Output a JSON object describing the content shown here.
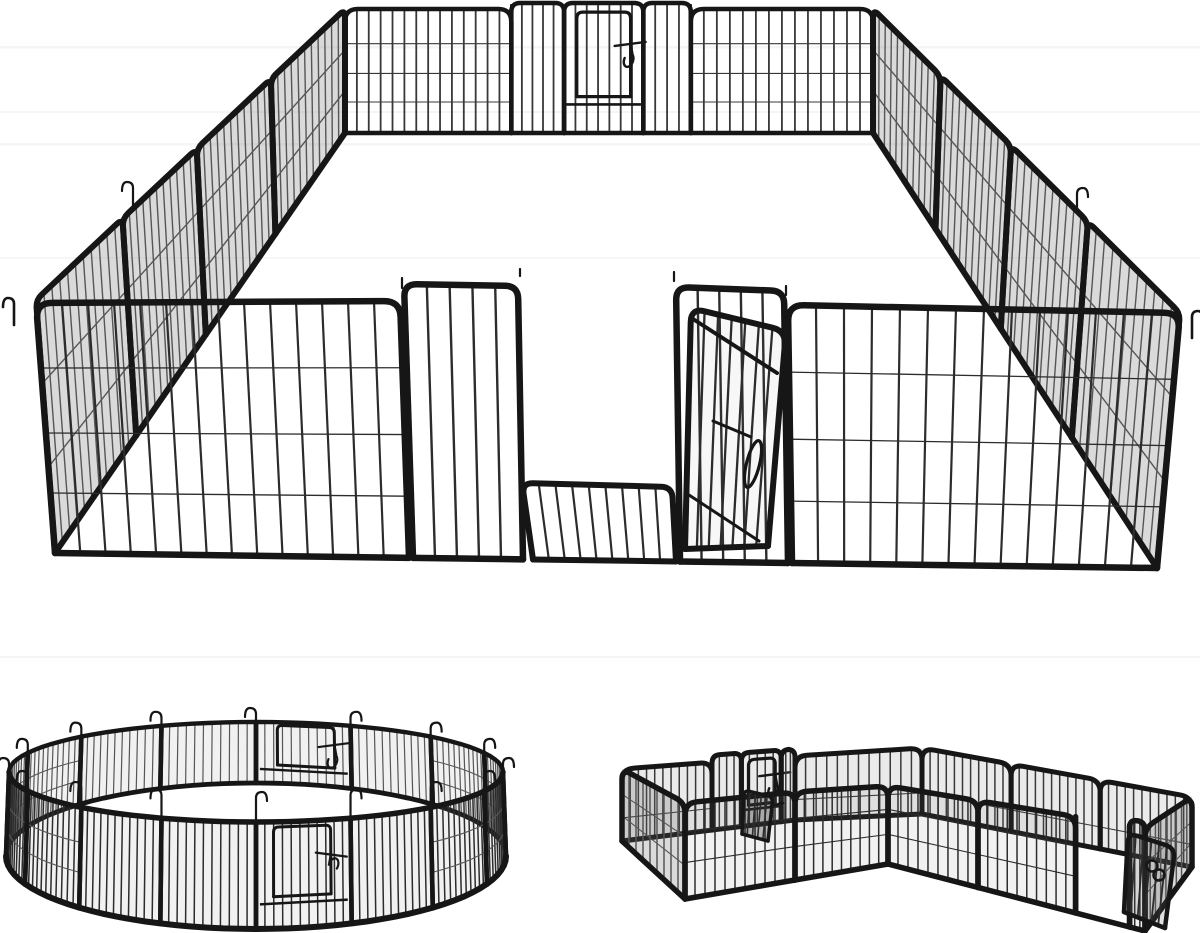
{
  "scene": {
    "description": "black metal heavy-duty pet playpen panels shown assembled in three layouts on a white background"
  },
  "colors": {
    "background": "#ffffff",
    "frame": "#161616",
    "bar_front": "#2c2c2c",
    "bar_back": "#383838",
    "bar_shaded": "#565656",
    "panel_shade_light": "rgba(120,120,120,0.10)",
    "panel_shade_mid": "rgba(115,115,115,0.15)",
    "panel_shade_dark": "rgba(100,100,100,0.24)",
    "door_shade": "rgba(40,40,40,0.30)",
    "stripe": "#ededed"
  },
  "layouts": [
    {
      "id": "rectangle",
      "name": "large rectangular pen",
      "position": "top",
      "visible_panels": 16,
      "corner_hook_pins": 4,
      "gates": [
        {
          "location": "back-center",
          "door": "closed",
          "latch": true
        },
        {
          "location": "front-center",
          "door": "open",
          "latch": true
        }
      ]
    },
    {
      "id": "circle",
      "name": "circular pen",
      "position": "bottom-left",
      "visible_panels": 16,
      "joint_anchor_pins": 16,
      "gates": [
        {
          "location": "front",
          "door": "closed",
          "latch": true
        },
        {
          "location": "back",
          "door": "closed",
          "latch": true
        }
      ]
    },
    {
      "id": "l-shape",
      "name": "L-shaped double pen",
      "position": "bottom-right",
      "visible_panels": 14,
      "gates": [
        {
          "location": "back-left",
          "door": "open",
          "latch": true
        },
        {
          "location": "front-right",
          "door": "open",
          "latch": true
        }
      ]
    }
  ],
  "ring_geometry": {
    "cx": 256,
    "top_cy": 772,
    "top_rx": 247,
    "top_ry": 50,
    "bottom_cy": 856,
    "bottom_rx": 250,
    "bottom_ry": 73,
    "panels": 16,
    "bars_per_panel": 10
  }
}
